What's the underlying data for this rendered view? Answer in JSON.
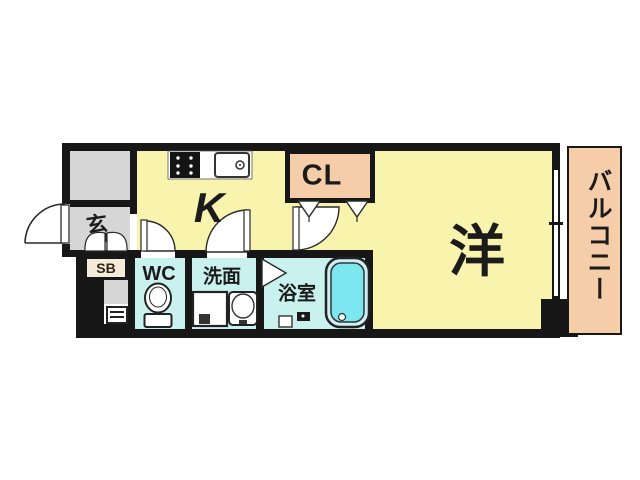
{
  "title": "1K apartment floor plan",
  "labels": {
    "entrance": "玄",
    "shoe_box": "SB",
    "kitchen": "K",
    "closet": "CL",
    "western_room": "洋",
    "balcony": "バルコニー",
    "toilet": "WC",
    "washroom": "洗面",
    "bathroom": "浴室"
  },
  "icons": [
    "stove-icon",
    "kitchen-sink-icon",
    "toilet-icon",
    "washing-machine-icon",
    "vanity-sink-icon",
    "bathtub-icon",
    "drain-icon",
    "stool-icon",
    "shelf-icon",
    "door-swing-icon",
    "folding-door-icon",
    "sliding-door-icon",
    "window-icon",
    "pillar-icon",
    "shoe-cabinet-doors-icon"
  ],
  "colors": {
    "room-yellow": "#f8f4ae",
    "wet-cyan": "#c9f1ed",
    "closet-salmon": "#f5cda9",
    "balcony-salmon": "#f5cda9",
    "hall-gray": "#d6d6d6",
    "tub-cyan": "#7de7ef",
    "tub-rim": "#cdeef2",
    "wall-black": "#171717",
    "sb-cream": "#f4ebd9",
    "line": "#2a2a2a",
    "bg": "#ffffff"
  }
}
